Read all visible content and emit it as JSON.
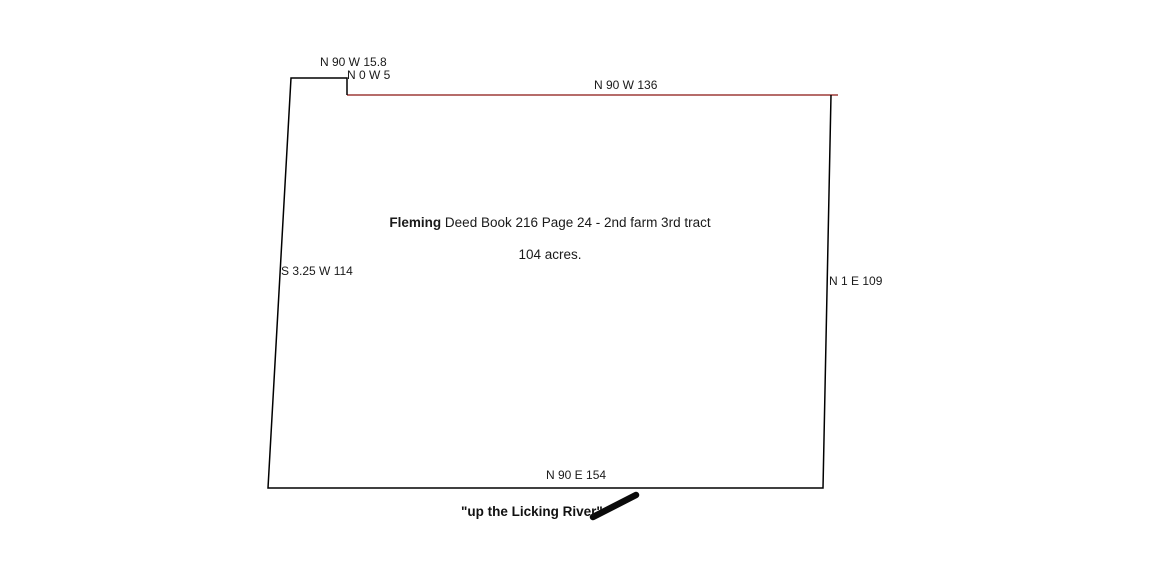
{
  "tract": {
    "owner": "Fleming",
    "deed_ref": " Deed Book 216 Page 24 - 2nd farm 3rd tract",
    "acreage": "104 acres.",
    "river_note": "\"up the Licking River\""
  },
  "bearings": {
    "top_notch": "N 90 W 15.8",
    "notch_drop": "N 0 W 5",
    "top": "N 90 W 136",
    "left": "S 3.25 W 114",
    "right": "N 1 E 109",
    "bottom": "N 90 E 154"
  },
  "colors": {
    "outline": "#000000",
    "top_boundary": "#9d3b38",
    "river_stroke": "#0a0a0a",
    "canvas": "#ffffff"
  }
}
